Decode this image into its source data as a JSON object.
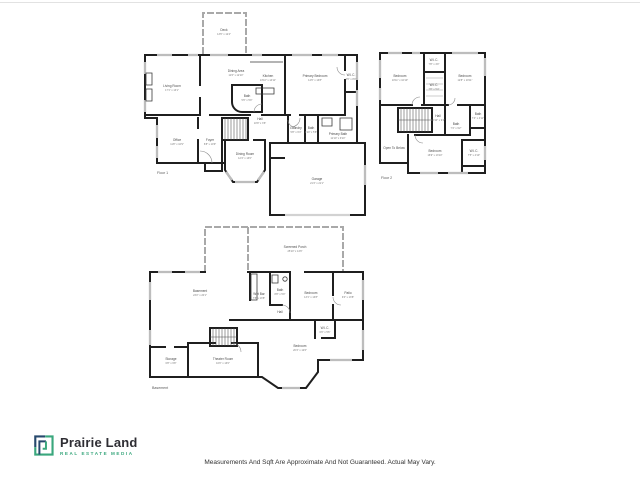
{
  "page": {
    "disclaimer": "Measurements And Sqft Are Approximate And Not Guaranteed. Actual May Vary."
  },
  "logo": {
    "name": "Prairie Land",
    "tagline": "REAL ESTATE MEDIA",
    "accent_green": "#3aa77d",
    "navy": "#27496d"
  },
  "floor1": {
    "label": "Floor 1",
    "rooms": {
      "deck": {
        "name": "Deck",
        "dims": "13'6\" x 12'4\""
      },
      "living_room": {
        "name": "Living Room",
        "dims": "17'1\" x 13'1\""
      },
      "dining_area": {
        "name": "Dining Area",
        "dims": "11'6\" x 12'10\""
      },
      "kitchen": {
        "name": "Kitchen",
        "dims": "13'10\" x 14'11\""
      },
      "primary_bedroom": {
        "name": "Primary Bedroom",
        "dims": "14'6\" x 13'8\""
      },
      "wic": {
        "name": "W.I.C.",
        "dims": "3'6\" x 8'0\""
      },
      "bath": {
        "name": "Bath",
        "dims": "5'6\" x 5'0\""
      },
      "office": {
        "name": "Office",
        "dims": "11'8\" x 10'9\""
      },
      "foyer": {
        "name": "Foyer",
        "dims": "6'8\" x 10'9\""
      },
      "hall": {
        "name": "Hall",
        "dims": "10'8\" x 3'6\""
      },
      "laundry": {
        "name": "Laundry",
        "dims": "5'8\" x 6'4\""
      },
      "bath2": {
        "name": "Bath",
        "dims": "4'10\" x 5'8\""
      },
      "primary_bath": {
        "name": "Primary Bath",
        "dims": "11'10\" x 9'10\""
      },
      "dining_room": {
        "name": "Dining Room",
        "dims": "12'4\" x 13'0\""
      },
      "garage": {
        "name": "Garage",
        "dims": "21'4\" x 21'1\""
      }
    }
  },
  "floor2": {
    "label": "Floor 2",
    "rooms": {
      "bedroom_a": {
        "name": "Bedroom",
        "dims": "10'11\" x 10'10\""
      },
      "wic_a": {
        "name": "W.I.C.",
        "dims": "7'8\" x 4'0\""
      },
      "wic_b": {
        "name": "W.I.C.",
        "dims": "7'8\" x 5'4\""
      },
      "bedroom_b": {
        "name": "Bedroom",
        "dims": "12'8\" x 10'11\""
      },
      "hall": {
        "name": "Hall",
        "dims": "10'10\" x 9'4\""
      },
      "bath_a": {
        "name": "Bath",
        "dims": "7'4\" x 4'11\""
      },
      "bath_b": {
        "name": "Bath",
        "dims": "7'4\" x 9'2\""
      },
      "open_below": {
        "name": "Open To Below",
        "dims": ""
      },
      "bedroom_c": {
        "name": "Bedroom",
        "dims": "16'9\" x 13'10\""
      },
      "wic_c": {
        "name": "W.I.C.",
        "dims": "7'5\" x 4'10\""
      }
    }
  },
  "basement": {
    "label": "Basement",
    "rooms": {
      "screened_porch": {
        "name": "Screened Porch",
        "dims": "25'10\" x 14'6\""
      },
      "basement": {
        "name": "Basement",
        "dims": "23'2\" x 20'1\""
      },
      "wet_bar": {
        "name": "Wet Bar",
        "dims": "7'8\" x 13'8\""
      },
      "bath": {
        "name": "Bath",
        "dims": "8'8\" x 5'0\""
      },
      "hall": {
        "name": "Hall",
        "dims": "8'8\" x 3'0\""
      },
      "bedroom_d": {
        "name": "Bedroom",
        "dims": "13'1\" x 13'8\""
      },
      "patio": {
        "name": "Patio",
        "dims": "9'4\" x 13'8\""
      },
      "wic_d": {
        "name": "W.I.C.",
        "dims": "6'0\" x 5'6\""
      },
      "bedroom_e": {
        "name": "Bedroom",
        "dims": "20'4\" x 12'6\""
      },
      "storage": {
        "name": "Storage",
        "dims": "6'8\" x 6'8\""
      },
      "theater_room": {
        "name": "Theater Room",
        "dims": "16'0\" x 13'0\""
      }
    }
  }
}
